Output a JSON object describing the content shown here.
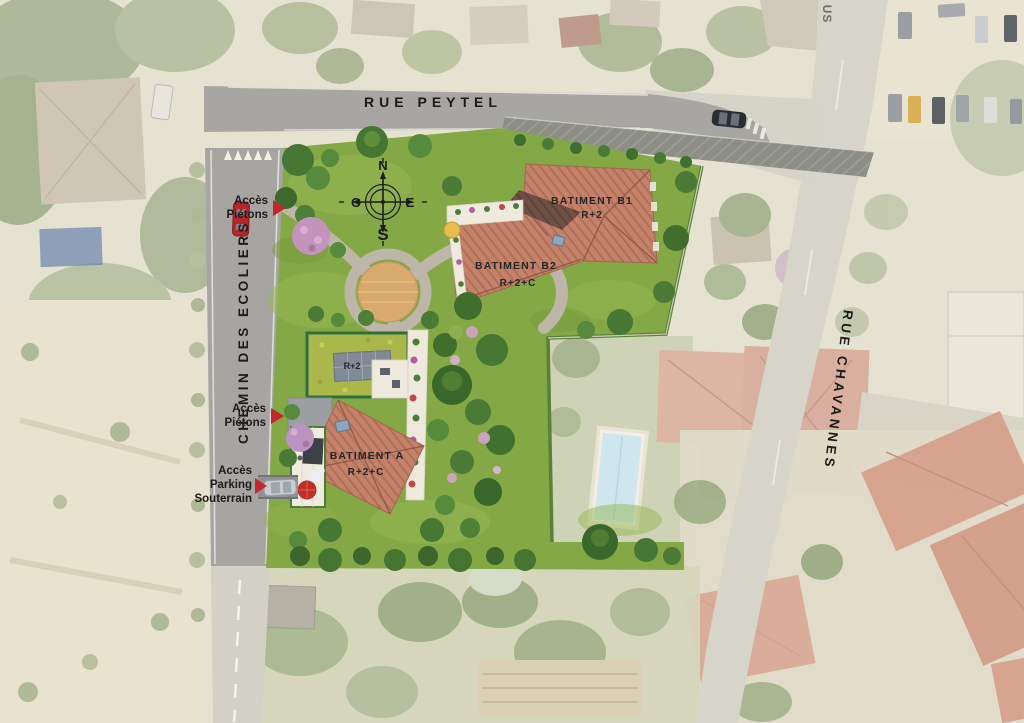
{
  "plan": {
    "title": "Plan masse aérien résidence",
    "streets": {
      "rue_peytel": "RUE PEYTEL",
      "chemin_des_ecoliers": "CHEMIN DES ECOLIERS",
      "rue_chavannes": "RUE CHAVANNES",
      "partial_street": "US"
    },
    "access": [
      {
        "id": "acces-pietons-1",
        "lines": [
          "Accès",
          "Piétons"
        ]
      },
      {
        "id": "acces-pietons-2",
        "lines": [
          "Accès",
          "Piétons"
        ]
      },
      {
        "id": "acces-parking",
        "lines": [
          "Accès",
          "Parking",
          "Souterrain"
        ]
      }
    ],
    "buildings": {
      "b1": {
        "name": "BATIMENT B1",
        "level": "R+2"
      },
      "b2": {
        "name": "BATIMENT B2",
        "level": "R+2+C"
      },
      "a": {
        "name": "BATIMENT A",
        "level": "R+2+C"
      },
      "green_roof": {
        "level": "R+2"
      }
    },
    "compass": {
      "n": "N",
      "s": "S",
      "e": "E",
      "w": "O"
    },
    "colors": {
      "lawn_green": "#84a845",
      "roof_salmon": "#c4826a",
      "roof_dark_section": "#6e5044",
      "green_roof": "#aab84b",
      "road_gray": "#a7a5a2",
      "sidewalk_dark": "#8d8f87",
      "plaza_tan": "#d9aa6e",
      "access_arrow_red": "#c1272d",
      "pool_blue": "#cfe6ee",
      "pink_blossom": "#c493bd"
    }
  }
}
